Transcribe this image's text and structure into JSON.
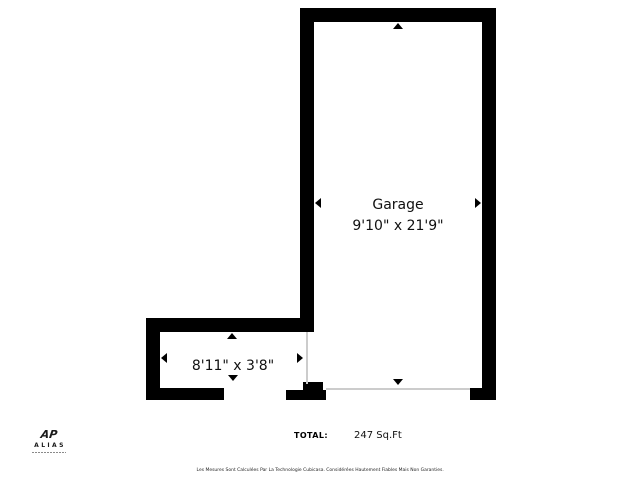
{
  "floorplan": {
    "garage": {
      "name": "Garage",
      "dimensions": "9'10\" x 21'9\""
    },
    "side_room": {
      "dimensions": "8'11\" x 3'8\""
    },
    "total": {
      "label": "TOTAL:",
      "value": "247 Sq.Ft"
    },
    "disclaimer": "Les Mesures Sont Calculées Par La Technologie Cubicasa. Considérées Hautement Fiables Mais Non Garanties.",
    "colors": {
      "wall": "#000000",
      "background": "#ffffff",
      "opening_line": "#cccccc"
    }
  },
  "branding": {
    "monogram": "AP",
    "name": "ALIAS"
  }
}
